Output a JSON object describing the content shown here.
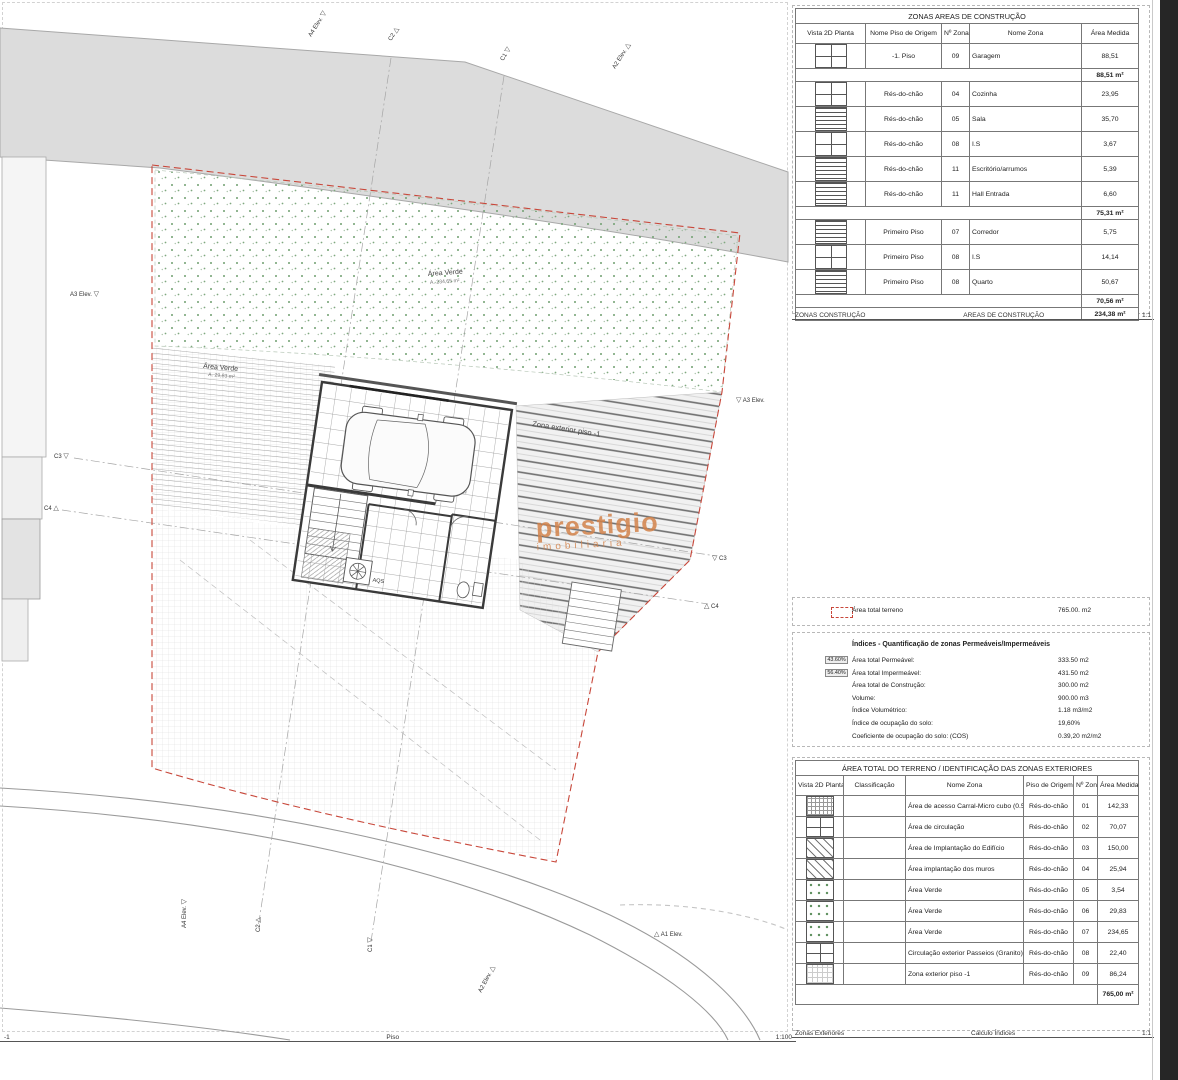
{
  "sheet_construcao": {
    "title": "ZONAS AREAS DE CONSTRUÇÃO",
    "columns": [
      "Vista 2D Planta",
      "Nome Piso de Origem",
      "Nº Zona",
      "Nome Zona",
      "Área Medida"
    ],
    "rows": [
      {
        "hatch": "window",
        "piso": "-1. Piso",
        "num": "09",
        "zona": "Garagem",
        "area": "88,51"
      },
      {
        "subtotal": "88,51 m²"
      },
      {
        "hatch": "window",
        "piso": "Rés-do-chão",
        "num": "04",
        "zona": "Cozinha",
        "area": "23,95"
      },
      {
        "hatch": "hlines",
        "piso": "Rés-do-chão",
        "num": "05",
        "zona": "Sala",
        "area": "35,70"
      },
      {
        "hatch": "window",
        "piso": "Rés-do-chão",
        "num": "08",
        "zona": "I.S",
        "area": "3,67"
      },
      {
        "hatch": "hlines",
        "piso": "Rés-do-chão",
        "num": "11",
        "zona": "Escritório/arrumos",
        "area": "5,39"
      },
      {
        "hatch": "hlines",
        "piso": "Rés-do-chão",
        "num": "11",
        "zona": "Hall Entrada",
        "area": "6,60"
      },
      {
        "subtotal": "75,31 m²"
      },
      {
        "hatch": "hlines",
        "piso": "Primeiro Piso",
        "num": "07",
        "zona": "Corredor",
        "area": "5,75"
      },
      {
        "hatch": "window",
        "piso": "Primeiro Piso",
        "num": "08",
        "zona": "I.S",
        "area": "14,14"
      },
      {
        "hatch": "hlines",
        "piso": "Primeiro Piso",
        "num": "08",
        "zona": "Quarto",
        "area": "50,67"
      },
      {
        "subtotal": "70,56 m²"
      },
      {
        "subtotal": "234,38 m²"
      }
    ],
    "footer_left": "ZONAS CONSTRUÇÃO",
    "footer_center": "AREAS DE CONSTRUÇÃO",
    "footer_scale": "1:1"
  },
  "terreno_box": {
    "label": "Área total terreno",
    "value": "765.00. m2"
  },
  "indices": {
    "title": "Índices - Quantificação de zonas Permeáveis/Impermeáveis",
    "rows": [
      {
        "pct": "43.60%",
        "label": "Área total Permeável:",
        "value": "333.50 m2"
      },
      {
        "pct": "56.40%",
        "label": "Área total Impermeável:",
        "value": "431.50 m2"
      },
      {
        "label": "Área total de Construção:",
        "value": "300.00 m2"
      },
      {
        "label": "Volume:",
        "value": "900.00 m3"
      },
      {
        "label": "Índice Volumétrico:",
        "value": "1.18 m3/m2"
      },
      {
        "label": "Índice de ocupação do solo:",
        "value": "19,60%"
      },
      {
        "label": "Coeficiente de ocupação do solo: (COS)",
        "value": "0.39,20 m2/m2"
      }
    ]
  },
  "sheet_exteriores": {
    "title": "ÁREA TOTAL DO TERRENO / IDENTIFICAÇÃO DAS ZONAS EXTERIORES",
    "columns": [
      "Vista 2D Planta",
      "Classificação",
      "Nome Zona",
      "Piso de Origem",
      "Nº Zona",
      "Área Medida"
    ],
    "rows": [
      {
        "hatch": "fgrid",
        "classificacao": "",
        "zona": "Área de acesso Carral-Micro cubo (0.5x0.5)",
        "piso": "Rés-do-chão",
        "num": "01",
        "area": "142,33"
      },
      {
        "hatch": "window",
        "classificacao": "",
        "zona": "Área de circulação",
        "piso": "Rés-do-chão",
        "num": "02",
        "area": "70,07"
      },
      {
        "hatch": "diag",
        "classificacao": "",
        "zona": "Área de Implantação do Edifício",
        "piso": "Rés-do-chão",
        "num": "03",
        "area": "150,00"
      },
      {
        "hatch": "diag",
        "classificacao": "",
        "zona": "Área implantação dos muros",
        "piso": "Rés-do-chão",
        "num": "04",
        "area": "25,94"
      },
      {
        "hatch": "dots",
        "classificacao": "",
        "zona": "Área Verde",
        "piso": "Rés-do-chão",
        "num": "05",
        "area": "3,54"
      },
      {
        "hatch": "dots",
        "classificacao": "",
        "zona": "Área Verde",
        "piso": "Rés-do-chão",
        "num": "06",
        "area": "29,83"
      },
      {
        "hatch": "dots",
        "classificacao": "",
        "zona": "Área Verde",
        "piso": "Rés-do-chão",
        "num": "07",
        "area": "234,65"
      },
      {
        "hatch": "window",
        "classificacao": "",
        "zona": "Circulação exterior Passeios (Granito)",
        "piso": "Rés-do-chão",
        "num": "08",
        "area": "22,40"
      },
      {
        "hatch": "lgrid",
        "classificacao": "",
        "zona": "Zona exterior piso -1",
        "piso": "Rés-do-chão",
        "num": "09",
        "area": "86,24"
      },
      {
        "total": "765,00 m²"
      }
    ],
    "footer_left": "Zonas Exteriores",
    "footer_center": "Calculo Índices",
    "footer_scale": "1:1"
  },
  "drawing": {
    "labels": {
      "area_verde_top": "Área Verde",
      "area_verde_top_sub": "A. 234,65 m²",
      "area_verde_left": "Área Verde",
      "area_verde_left_sub": "A. 29,83 m²",
      "zona_exterior": "Zona exterior piso -1",
      "garagem": "Garagem",
      "garagem_area": "A. 88,51 m²",
      "aqs": "AQS"
    },
    "markers": [
      {
        "label": "A4",
        "sub": "Elev."
      },
      {
        "label": "C2"
      },
      {
        "label": "C1"
      },
      {
        "label": "A2",
        "sub": "Elev."
      },
      {
        "label": "A3",
        "sub": "Elev."
      },
      {
        "label": "C3"
      },
      {
        "label": "C4"
      },
      {
        "label": "A3",
        "sub": "Elev."
      },
      {
        "label": "C3"
      },
      {
        "label": "C4"
      },
      {
        "label": "A4",
        "sub": "Elev."
      },
      {
        "label": "C2"
      },
      {
        "label": "C1"
      },
      {
        "label": "A2",
        "sub": "Elev."
      },
      {
        "label": "A1",
        "sub": "Elev."
      }
    ],
    "footer": {
      "left": "-1",
      "center": "Piso",
      "scale": "1:100"
    },
    "watermark": {
      "line1": "prestigio",
      "line2": "imobiliaria",
      "color": "#d3834b"
    }
  },
  "colors": {
    "boundary_red": "#c8473a",
    "green_dot": "#6f9f6f",
    "road_gray": "#dcdcdc"
  }
}
